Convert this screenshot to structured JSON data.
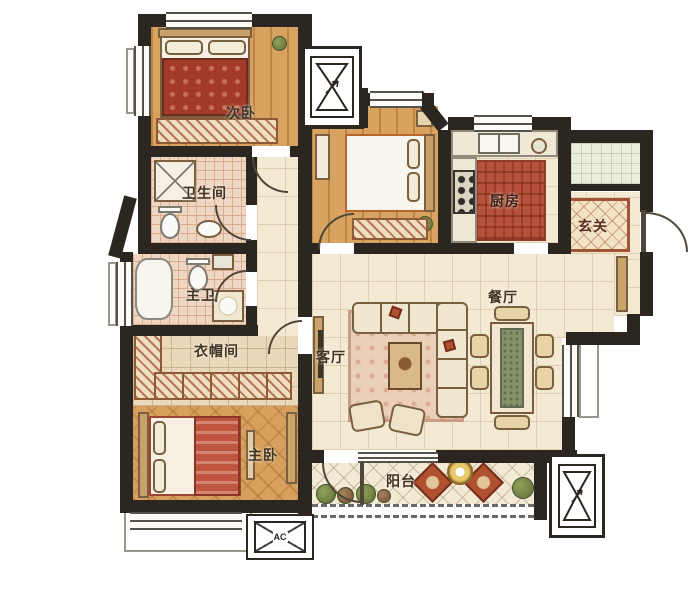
{
  "rooms": [
    {
      "id": "secondary-bedroom",
      "label": "次卧"
    },
    {
      "id": "guest-bathroom",
      "label": "卫生间"
    },
    {
      "id": "master-bathroom",
      "label": "主卫"
    },
    {
      "id": "cloakroom",
      "label": "衣帽间"
    },
    {
      "id": "master-bedroom",
      "label": "主卧"
    },
    {
      "id": "living-room",
      "label": "客厅"
    },
    {
      "id": "dining-room",
      "label": "餐厅"
    },
    {
      "id": "kitchen",
      "label": "厨房"
    },
    {
      "id": "foyer",
      "label": "玄关"
    },
    {
      "id": "balcony",
      "label": "阳台"
    }
  ],
  "annotations": {
    "ac_label": "AC"
  },
  "icons": {
    "elevator": "hourglass-shaft",
    "utility_shaft": "hourglass-shaft",
    "ac_platform": "crossed-box",
    "door": "quarter-arc",
    "window": "triple-line"
  },
  "colors": {
    "background": "#ffffff",
    "wall": "#2b2620",
    "label": "#3f3322",
    "woodFloor": "#d8a261",
    "woodStripe": "#bc8544",
    "parquet": "#d7a05e",
    "creamTile": "#f4ead4",
    "creamLine": "#e0cfae",
    "bathTile": "#eed6c2",
    "bathLine": "#d9ac8e",
    "closetTile": "#e9d8ba",
    "kitchenBrick": "#b5513a",
    "rugPink": "#eacfb9",
    "bedRed": "#a23b28",
    "accentRed": "#b0502f",
    "furnCream": "#f0e7d1",
    "furnOutline": "#7a5f41",
    "green": "#75834a",
    "runnerGreen": "#85926a",
    "doorArc": "#4f463a",
    "windowFrame": "#55524c",
    "foyerRugBorder": "#a2543a"
  }
}
